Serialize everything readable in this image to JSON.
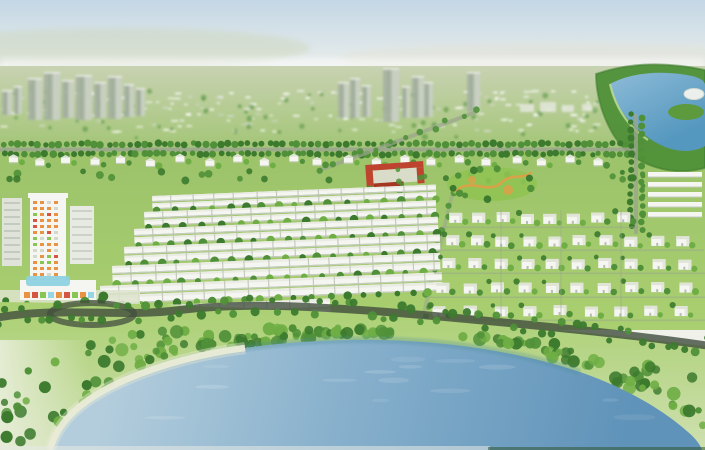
{
  "scene": {
    "type": "aerial-architectural-render",
    "subject": "master-planned residential community with central lake, river, townhouse rows, villa grid, school and high-rise mall complex",
    "width": 705,
    "height": 450
  },
  "palette": {
    "skyTop": "#c4d7e5",
    "skyMid": "#dbe5e9",
    "horizon": "#f0f1eb",
    "hazeGreen": "#ccd5b8",
    "distantLand": "#c8d2b2",
    "fieldGreen": "#9cc36a",
    "lawn": "#a9cf70",
    "lawnPale": "#cfe0b0",
    "brightLawn": "#8fc353",
    "treeDark": "#3c7a2e",
    "treeMid": "#4f9038",
    "treeLight": "#6fae45",
    "houseWhite": "#f5f6f2",
    "houseShadow": "#c6ccc1",
    "roofPale": "#e0e4d6",
    "ridge": "#eaece3",
    "gapGray": "#b9c0b2",
    "towerGray": "#a7b2a2",
    "towerLight": "#ced5c8",
    "schoolRed": "#bf4430",
    "schoolRedDark": "#a33722",
    "courtyard": "#d9dcc8",
    "parkOrange": "#dda049",
    "roadDark": "#414d3d",
    "roadLight": "#9aa58d",
    "riverBlue": "#5598bf",
    "riverLight": "#8fbcd8",
    "waterLight": "#b3cddc",
    "waterMid": "#87b0cc",
    "waterDeep": "#6093b9",
    "shoreTeal": "#4f8e9b",
    "sand": "#e9ebd6",
    "paleCorner": "#e9eedb",
    "mallCyan": "#8ed2e0",
    "accentOrange": "#e8872f",
    "accentRed": "#d2452c",
    "accentGreen": "#7cc142",
    "white": "#ffffff"
  },
  "background": {
    "towers": {
      "left": [
        [
          2,
          10,
          90,
          115
        ],
        [
          14,
          8,
          86,
          114
        ],
        [
          28,
          14,
          78,
          120
        ],
        [
          44,
          16,
          72,
          120
        ],
        [
          62,
          12,
          80,
          118
        ],
        [
          76,
          16,
          75,
          120
        ],
        [
          94,
          12,
          82,
          118
        ],
        [
          108,
          14,
          76,
          119
        ],
        [
          124,
          10,
          84,
          117
        ],
        [
          136,
          9,
          88,
          116
        ]
      ],
      "center": [
        [
          338,
          11,
          82,
          118
        ],
        [
          350,
          10,
          78,
          118
        ],
        [
          362,
          9,
          85,
          117
        ],
        [
          383,
          16,
          68,
          122
        ],
        [
          402,
          8,
          86,
          118
        ],
        [
          412,
          12,
          76,
          118
        ],
        [
          424,
          9,
          82,
          117
        ],
        [
          467,
          13,
          72,
          112
        ]
      ],
      "low_blocks": [
        [
          520,
          14,
          104,
          112
        ],
        [
          540,
          16,
          102,
          112
        ],
        [
          562,
          12,
          105,
          112
        ],
        [
          582,
          10,
          104,
          111
        ]
      ]
    },
    "speck_rows": 8
  },
  "river": {
    "bank": "M 596,74 C 630,62 668,62 705,70 L 705,168 C 676,176 648,168 630,154 C 610,138 596,104 596,74 Z",
    "water": "M 610,84 C 632,72 664,70 692,76 C 700,78 705,81 705,85 L 705,146 C 688,156 664,150 646,136 C 626,120 612,102 610,84 Z",
    "peninsula": {
      "cx": 686,
      "cy": 112,
      "rx": 18,
      "ry": 8
    },
    "stadium": {
      "cx": 694,
      "cy": 94,
      "rx": 10,
      "ry": 5.5
    }
  },
  "roads": {
    "boulevard": {
      "y": 147.5,
      "x1": 0,
      "x2": 636
    },
    "vertical": {
      "x": 634,
      "y1": 114,
      "y2": 234
    },
    "diagonal1": {
      "x1": 476,
      "y1": 112,
      "x2": 320,
      "y2": 170
    },
    "diagonal2": {
      "x1": 452,
      "y1": 195,
      "x2": 420,
      "y2": 330
    },
    "front_road": "M -5,318 C 60,306 120,318 180,310 C 240,303 300,306 360,310 C 430,315 500,322 560,328 C 620,334 670,340 710,346",
    "loop": {
      "cx": 92,
      "cy": 314,
      "rx": 42,
      "ry": 11
    }
  },
  "districts": {
    "upper_villa_row": {
      "y": 156,
      "count": 22,
      "x_start": 4,
      "spacing": 28
    },
    "rowhouse_rows": [
      {
        "y": 196,
        "x1": 152,
        "x2": 436,
        "h": 5
      },
      {
        "y": 212,
        "x1": 144,
        "x2": 436,
        "h": 5.5
      },
      {
        "y": 229,
        "x1": 134,
        "x2": 438,
        "h": 6
      },
      {
        "y": 247,
        "x1": 124,
        "x2": 440,
        "h": 6.5
      },
      {
        "y": 266,
        "x1": 112,
        "x2": 440,
        "h": 7
      },
      {
        "y": 286,
        "x1": 100,
        "x2": 442,
        "h": 7.5
      },
      {
        "y": 307,
        "x1": 118,
        "x2": 330,
        "h": 8
      }
    ],
    "villa_rows": [
      {
        "y": 212,
        "x1": 448,
        "x2": 638,
        "n": 8
      },
      {
        "y": 235,
        "x1": 444,
        "x2": 700,
        "n": 10
      },
      {
        "y": 258,
        "x1": 440,
        "x2": 702,
        "n": 10
      },
      {
        "y": 282,
        "x1": 436,
        "x2": 704,
        "n": 10
      },
      {
        "y": 305,
        "x1": 432,
        "x2": 702,
        "n": 9
      }
    ],
    "edge_strips": {
      "x": 648,
      "width": 54,
      "ys": [
        172,
        182,
        192,
        202,
        212
      ]
    }
  },
  "landmarks": {
    "school": {
      "x": 366,
      "y": 163,
      "w": 58,
      "h": 24
    },
    "park": {
      "cx": 492,
      "cy": 184,
      "rx": 45,
      "ry": 17
    },
    "mall_tower": {
      "x": 0,
      "y": 193
    }
  },
  "lake": {
    "outline": "M 52,450 C 60,418 85,398 125,380 C 180,356 255,342 345,340 C 440,338 520,352 580,372 C 632,390 668,414 688,432 C 695,438 700,444 702,450 Z",
    "beach": "M 50,450 C 58,420 84,398 125,380 C 162,364 205,353 245,348",
    "near_shore": "M 125,380 C 180,356 255,342 345,340 C 440,338 520,352 580,372",
    "shoreline": [
      [
        0,
        450
      ],
      [
        52,
        450
      ],
      [
        90,
        412
      ],
      [
        125,
        380
      ],
      [
        170,
        362
      ],
      [
        230,
        352
      ],
      [
        345,
        340
      ],
      [
        440,
        338
      ],
      [
        520,
        352
      ],
      [
        580,
        372
      ],
      [
        620,
        390
      ],
      [
        660,
        414
      ],
      [
        690,
        432
      ],
      [
        705,
        442
      ]
    ]
  }
}
